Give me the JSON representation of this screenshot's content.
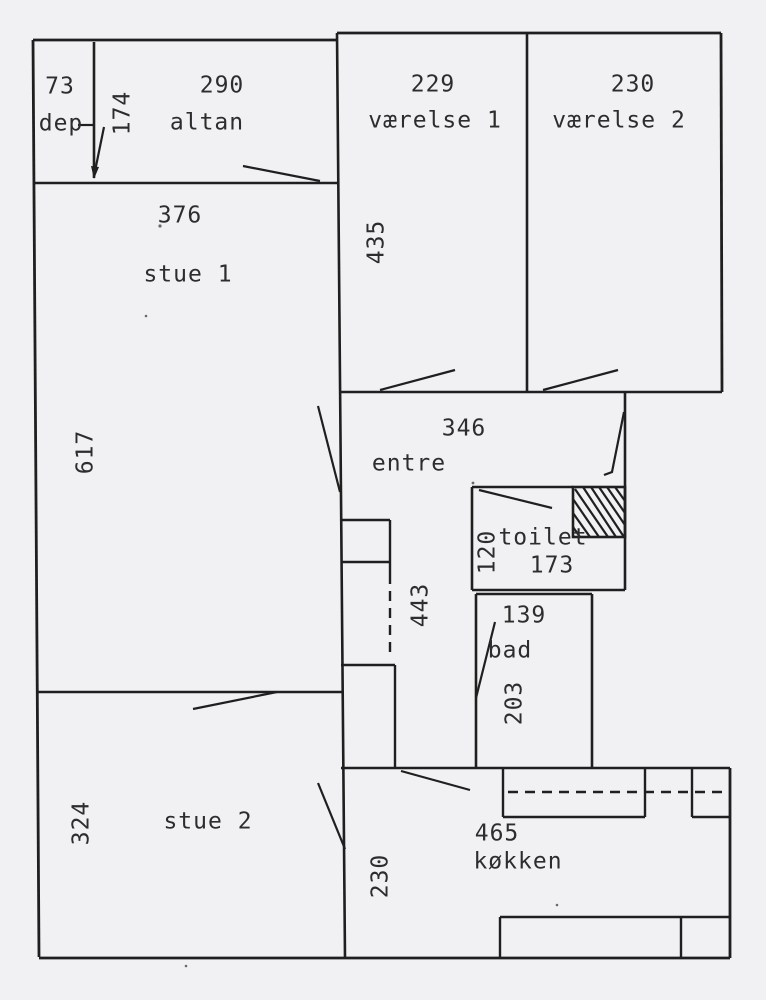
{
  "title": "Apartment floor plan (scanned drawing, dimensions in cm)",
  "colors": {
    "paper": "#f1f1f3",
    "ink": "#1f1f1f",
    "text": "#2d2d2d"
  },
  "rooms": {
    "dep": {
      "dim": "73",
      "label": "dep",
      "depth": "174"
    },
    "altan": {
      "dim": "290",
      "label": "altan"
    },
    "vaerelse1": {
      "dim": "229",
      "label": "værelse 1",
      "depth": "435"
    },
    "vaerelse2": {
      "dim": "230",
      "label": "værelse 2"
    },
    "stue1": {
      "dim": "376",
      "label": "stue 1",
      "depth": "617"
    },
    "entre": {
      "dim": "346",
      "label": "entre"
    },
    "hall": {
      "depth": "443",
      "width": "230"
    },
    "toilet": {
      "dim": "173",
      "label": "toilet",
      "width": "120"
    },
    "bad": {
      "dim": "139",
      "label": "bad",
      "depth": "203"
    },
    "stue2": {
      "dim": "324",
      "label": "stue 2"
    },
    "koekken": {
      "dim": "465",
      "label": "køkken"
    }
  }
}
